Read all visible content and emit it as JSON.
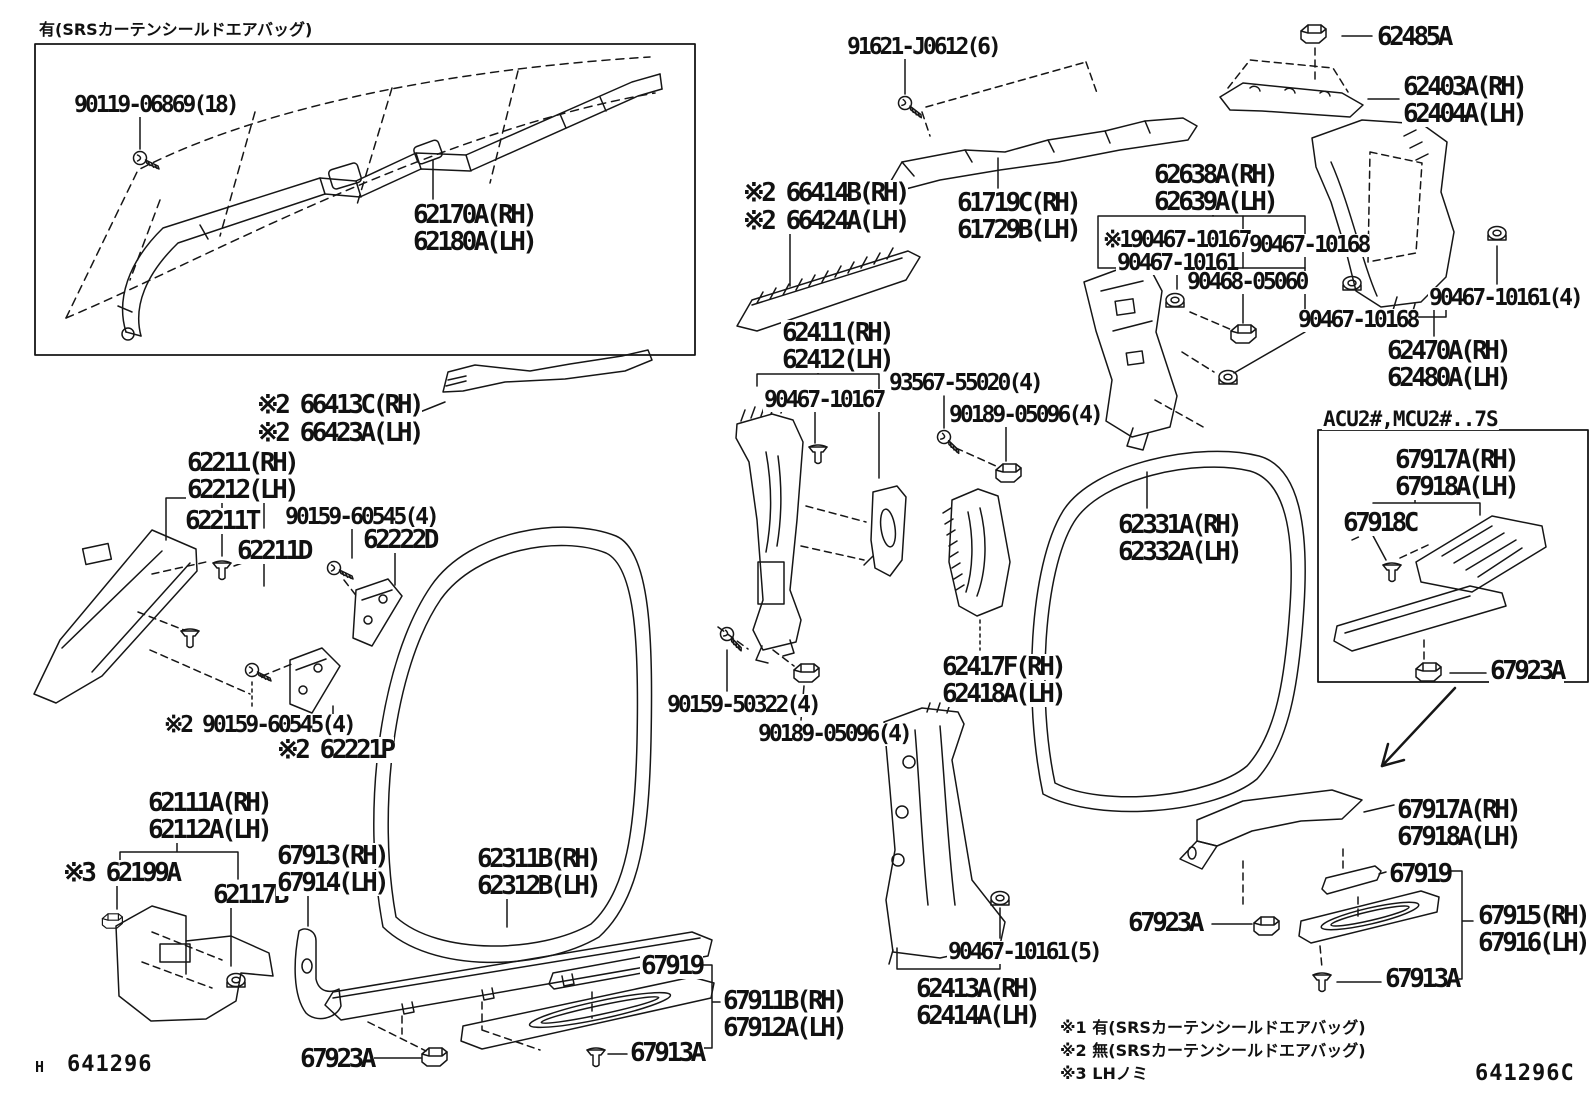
{
  "doc": {
    "type": "parts-diagram",
    "drawing_number_left": "641296",
    "drawing_number_left_prefix": "H",
    "drawing_number_right": "641296C",
    "header_note": "有(SRSカーテンシールドエアバッグ)",
    "acu_box_title": "ACU2#,MCU2#..7S",
    "footnotes": [
      "※1 有(SRSカーテンシールドエアバッグ)",
      "※2 無(SRSカーテンシールドエアバッグ)",
      "※3 LHノミ"
    ],
    "ink_color": "#161616",
    "paper_color": "#ffffff"
  },
  "labels": [
    {
      "t": "90119-06869(18)",
      "x": 73,
      "y": 94,
      "k": "sm"
    },
    {
      "t": "62170A(RH)",
      "x": 412,
      "y": 202,
      "k": "big"
    },
    {
      "t": "62180A(LH)",
      "x": 412,
      "y": 229,
      "k": "big"
    },
    {
      "t": "91621-J0612(6)",
      "x": 846,
      "y": 36,
      "k": "sm"
    },
    {
      "t": "※2 66414B(RH)",
      "x": 742,
      "y": 180,
      "k": "big"
    },
    {
      "t": "※2 66424A(LH)",
      "x": 742,
      "y": 208,
      "k": "big"
    },
    {
      "t": "61719C(RH)",
      "x": 956,
      "y": 190,
      "k": "big"
    },
    {
      "t": "61729B(LH)",
      "x": 956,
      "y": 217,
      "k": "big"
    },
    {
      "t": "62638A(RH)",
      "x": 1153,
      "y": 162,
      "k": "big"
    },
    {
      "t": "62639A(LH)",
      "x": 1153,
      "y": 189,
      "k": "big"
    },
    {
      "t": "62485A",
      "x": 1376,
      "y": 24,
      "k": "big"
    },
    {
      "t": "62403A(RH)",
      "x": 1402,
      "y": 74,
      "k": "big"
    },
    {
      "t": "62404A(LH)",
      "x": 1402,
      "y": 101,
      "k": "big"
    },
    {
      "t": "※190467-10167",
      "x": 1102,
      "y": 229,
      "k": "sm"
    },
    {
      "t": "90467-10161",
      "x": 1116,
      "y": 252,
      "k": "sm"
    },
    {
      "t": "90467-10168",
      "x": 1248,
      "y": 234,
      "k": "sm"
    },
    {
      "t": "90468-05060",
      "x": 1186,
      "y": 271,
      "k": "sm"
    },
    {
      "t": "90467-10168",
      "x": 1297,
      "y": 309,
      "k": "sm"
    },
    {
      "t": "90467-10161(4)",
      "x": 1428,
      "y": 287,
      "k": "sm"
    },
    {
      "t": "62470A(RH)",
      "x": 1386,
      "y": 338,
      "k": "big"
    },
    {
      "t": "62480A(LH)",
      "x": 1386,
      "y": 365,
      "k": "big"
    },
    {
      "t": "※2 66413C(RH)",
      "x": 256,
      "y": 392,
      "k": "big"
    },
    {
      "t": "※2 66423A(LH)",
      "x": 256,
      "y": 420,
      "k": "big"
    },
    {
      "t": "62411(RH)",
      "x": 781,
      "y": 320,
      "k": "big"
    },
    {
      "t": "62412(LH)",
      "x": 781,
      "y": 347,
      "k": "big"
    },
    {
      "t": "90467-10167",
      "x": 763,
      "y": 389,
      "k": "sm"
    },
    {
      "t": "93567-55020(4)",
      "x": 888,
      "y": 372,
      "k": "sm"
    },
    {
      "t": "90189-05096(4)",
      "x": 948,
      "y": 404,
      "k": "sm"
    },
    {
      "t": "62211(RH)",
      "x": 186,
      "y": 450,
      "k": "big"
    },
    {
      "t": "62212(LH)",
      "x": 186,
      "y": 477,
      "k": "big"
    },
    {
      "t": "62211T",
      "x": 184,
      "y": 508,
      "k": "big"
    },
    {
      "t": "62211D",
      "x": 236,
      "y": 538,
      "k": "big"
    },
    {
      "t": "90159-60545(4)",
      "x": 284,
      "y": 506,
      "k": "sm"
    },
    {
      "t": "62222D",
      "x": 362,
      "y": 527,
      "k": "big"
    },
    {
      "t": "62331A(RH)",
      "x": 1117,
      "y": 512,
      "k": "big"
    },
    {
      "t": "62332A(LH)",
      "x": 1117,
      "y": 539,
      "k": "big"
    },
    {
      "t": "67917A(RH)",
      "x": 1394,
      "y": 447,
      "k": "big"
    },
    {
      "t": "67918A(LH)",
      "x": 1394,
      "y": 474,
      "k": "big"
    },
    {
      "t": "67918C",
      "x": 1342,
      "y": 510,
      "k": "big"
    },
    {
      "t": "67923A",
      "x": 1489,
      "y": 658,
      "k": "big"
    },
    {
      "t": "62417F(RH)",
      "x": 941,
      "y": 654,
      "k": "big"
    },
    {
      "t": "62418A(LH)",
      "x": 941,
      "y": 681,
      "k": "big"
    },
    {
      "t": "90159-50322(4)",
      "x": 666,
      "y": 694,
      "k": "sm"
    },
    {
      "t": "90189-05096(4)",
      "x": 757,
      "y": 723,
      "k": "sm"
    },
    {
      "t": "※2 90159-60545(4)",
      "x": 163,
      "y": 714,
      "k": "sm"
    },
    {
      "t": "※2 62221P",
      "x": 276,
      "y": 737,
      "k": "big"
    },
    {
      "t": "62111A(RH)",
      "x": 147,
      "y": 790,
      "k": "big"
    },
    {
      "t": "62112A(LH)",
      "x": 147,
      "y": 817,
      "k": "big"
    },
    {
      "t": "※3 62199A",
      "x": 62,
      "y": 860,
      "k": "big"
    },
    {
      "t": "62117B",
      "x": 212,
      "y": 882,
      "k": "big"
    },
    {
      "t": "67913(RH)",
      "x": 276,
      "y": 843,
      "k": "big"
    },
    {
      "t": "67914(LH)",
      "x": 276,
      "y": 870,
      "k": "big"
    },
    {
      "t": "62311B(RH)",
      "x": 476,
      "y": 846,
      "k": "big"
    },
    {
      "t": "62312B(LH)",
      "x": 476,
      "y": 873,
      "k": "big"
    },
    {
      "t": "67919",
      "x": 640,
      "y": 953,
      "k": "big"
    },
    {
      "t": "67911B(RH)",
      "x": 722,
      "y": 988,
      "k": "big"
    },
    {
      "t": "67912A(LH)",
      "x": 722,
      "y": 1015,
      "k": "big"
    },
    {
      "t": "67913A",
      "x": 629,
      "y": 1040,
      "k": "big"
    },
    {
      "t": "67923A",
      "x": 299,
      "y": 1046,
      "k": "big"
    },
    {
      "t": "62413A(RH)",
      "x": 915,
      "y": 976,
      "k": "big"
    },
    {
      "t": "62414A(LH)",
      "x": 915,
      "y": 1003,
      "k": "big"
    },
    {
      "t": "90467-10161(5)",
      "x": 947,
      "y": 941,
      "k": "sm"
    },
    {
      "t": "67923A",
      "x": 1127,
      "y": 910,
      "k": "big"
    },
    {
      "t": "67917A(RH)",
      "x": 1396,
      "y": 797,
      "k": "big"
    },
    {
      "t": "67918A(LH)",
      "x": 1396,
      "y": 824,
      "k": "big"
    },
    {
      "t": "67919",
      "x": 1388,
      "y": 861,
      "k": "big"
    },
    {
      "t": "67915(RH)",
      "x": 1477,
      "y": 903,
      "k": "big"
    },
    {
      "t": "67916(LH)",
      "x": 1477,
      "y": 930,
      "k": "big"
    },
    {
      "t": "67913A",
      "x": 1384,
      "y": 966,
      "k": "big"
    }
  ]
}
